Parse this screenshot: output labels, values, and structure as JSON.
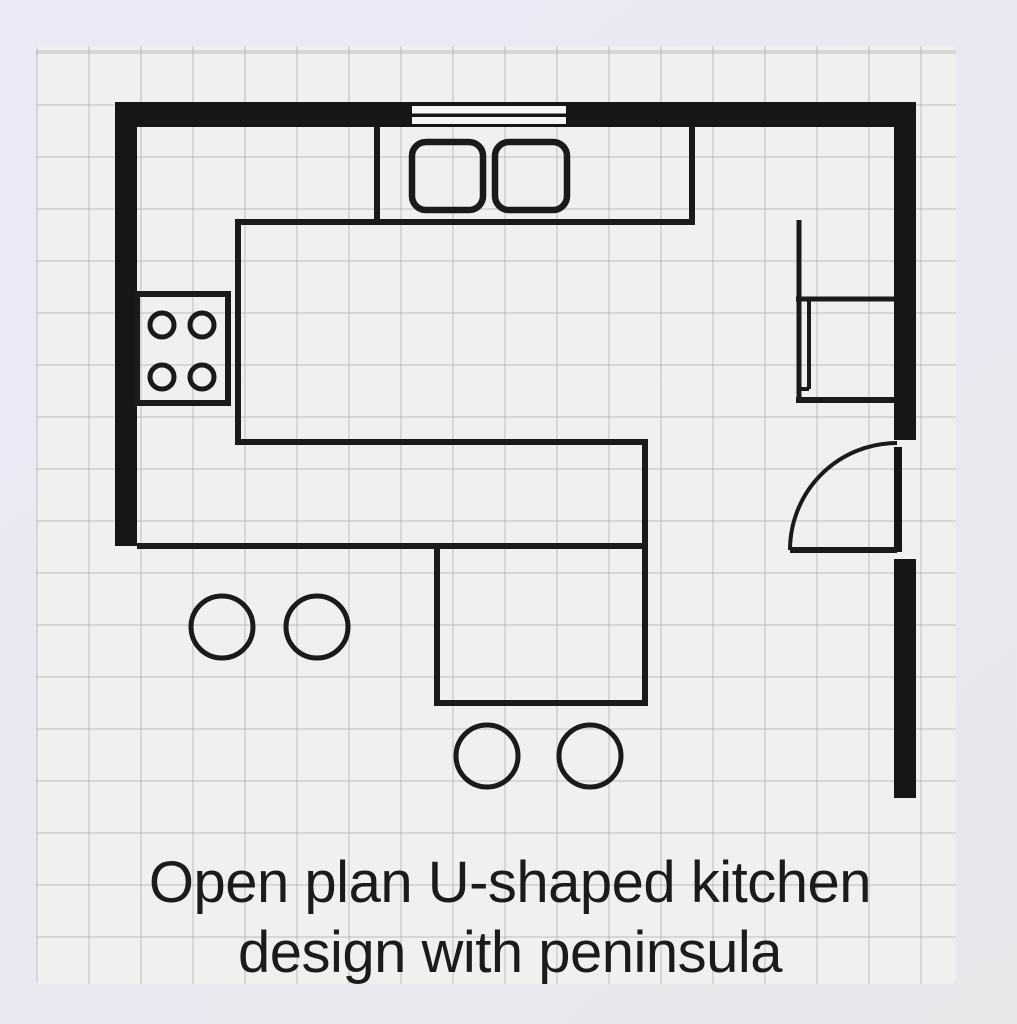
{
  "plan": {
    "type": "kitchen-floor-plan",
    "caption": {
      "line1": "Open plan U-shaped kitchen",
      "line2": "design with peninsula"
    },
    "fixtures": [
      "outer-walls",
      "window",
      "double-basin-sink",
      "four-burner-cooktop",
      "refrigerator",
      "tall-cabinet-run",
      "hinged-door-with-swing-arc",
      "u-shaped-counter",
      "peninsula",
      "bar-stools"
    ],
    "counts": {
      "sink_basins": 2,
      "burners": 4,
      "stools": 4
    },
    "colors": {
      "wall": "#161616",
      "line": "#1a1a1a",
      "paper": "#f1f0ee",
      "grid": "#d9d6d2",
      "background_top_left": "#ece8f8",
      "background_bottom_right": "#e8e7ea",
      "text": "#1b1b1b"
    }
  }
}
